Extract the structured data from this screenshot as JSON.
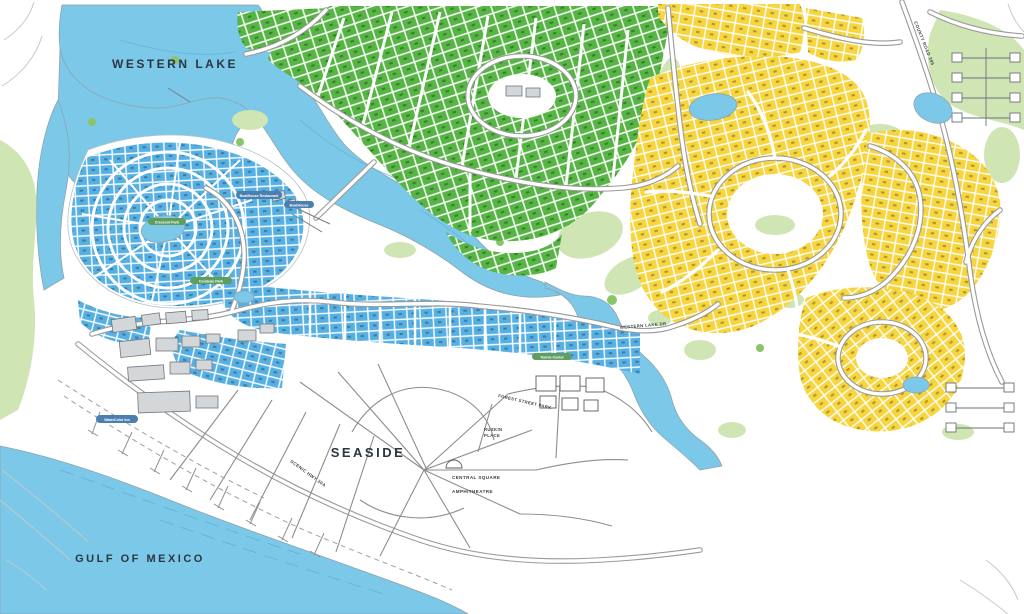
{
  "map": {
    "region_labels": {
      "western_lake": "WESTERN LAKE",
      "seaside": "SEASIDE",
      "gulf_of_mexico": "GULF OF MEXICO"
    },
    "place_labels": {
      "central_square": "CENTRAL SQUARE",
      "amphitheatre": "AMPHITHEATRE",
      "ruskin_line1": "RUSKIN",
      "ruskin_line2": "PLACE",
      "forest_street_park": "FOREST STREET PARK"
    },
    "road_labels": {
      "county_road_395": "COUNTY ROAD 395",
      "scenic_hwy_30a": "SCENIC HWY 30A",
      "western_lake_dr": "WESTERN LAKE DR"
    },
    "landmark_pills": {
      "boathouse_restaurant": "BoatHouse Restaurant",
      "boathouse": "BoatHouse",
      "watercolor_inn": "WaterColor Inn",
      "crescent_park": "Crescent Park",
      "cerulean_park": "Cerulean Park",
      "tennis_center": "Tennis Center"
    },
    "colors": {
      "water": "#7cc8e9",
      "water_deep": "#5fb0d4",
      "veg": "#cfe6b4",
      "veg_dark": "#8cc468",
      "green_lots": "#57b545",
      "blue_lots": "#57b0e4",
      "yellow_lots": "#f6d53f",
      "road_casing": "#9a9a9a",
      "road_fill": "#ffffff",
      "building_fill": "#d3d7d9",
      "building_stroke": "#70767c",
      "label_dark": "#2d3640",
      "pill_blue": "#4a7fae",
      "pill_green": "#5f9e5f"
    }
  }
}
